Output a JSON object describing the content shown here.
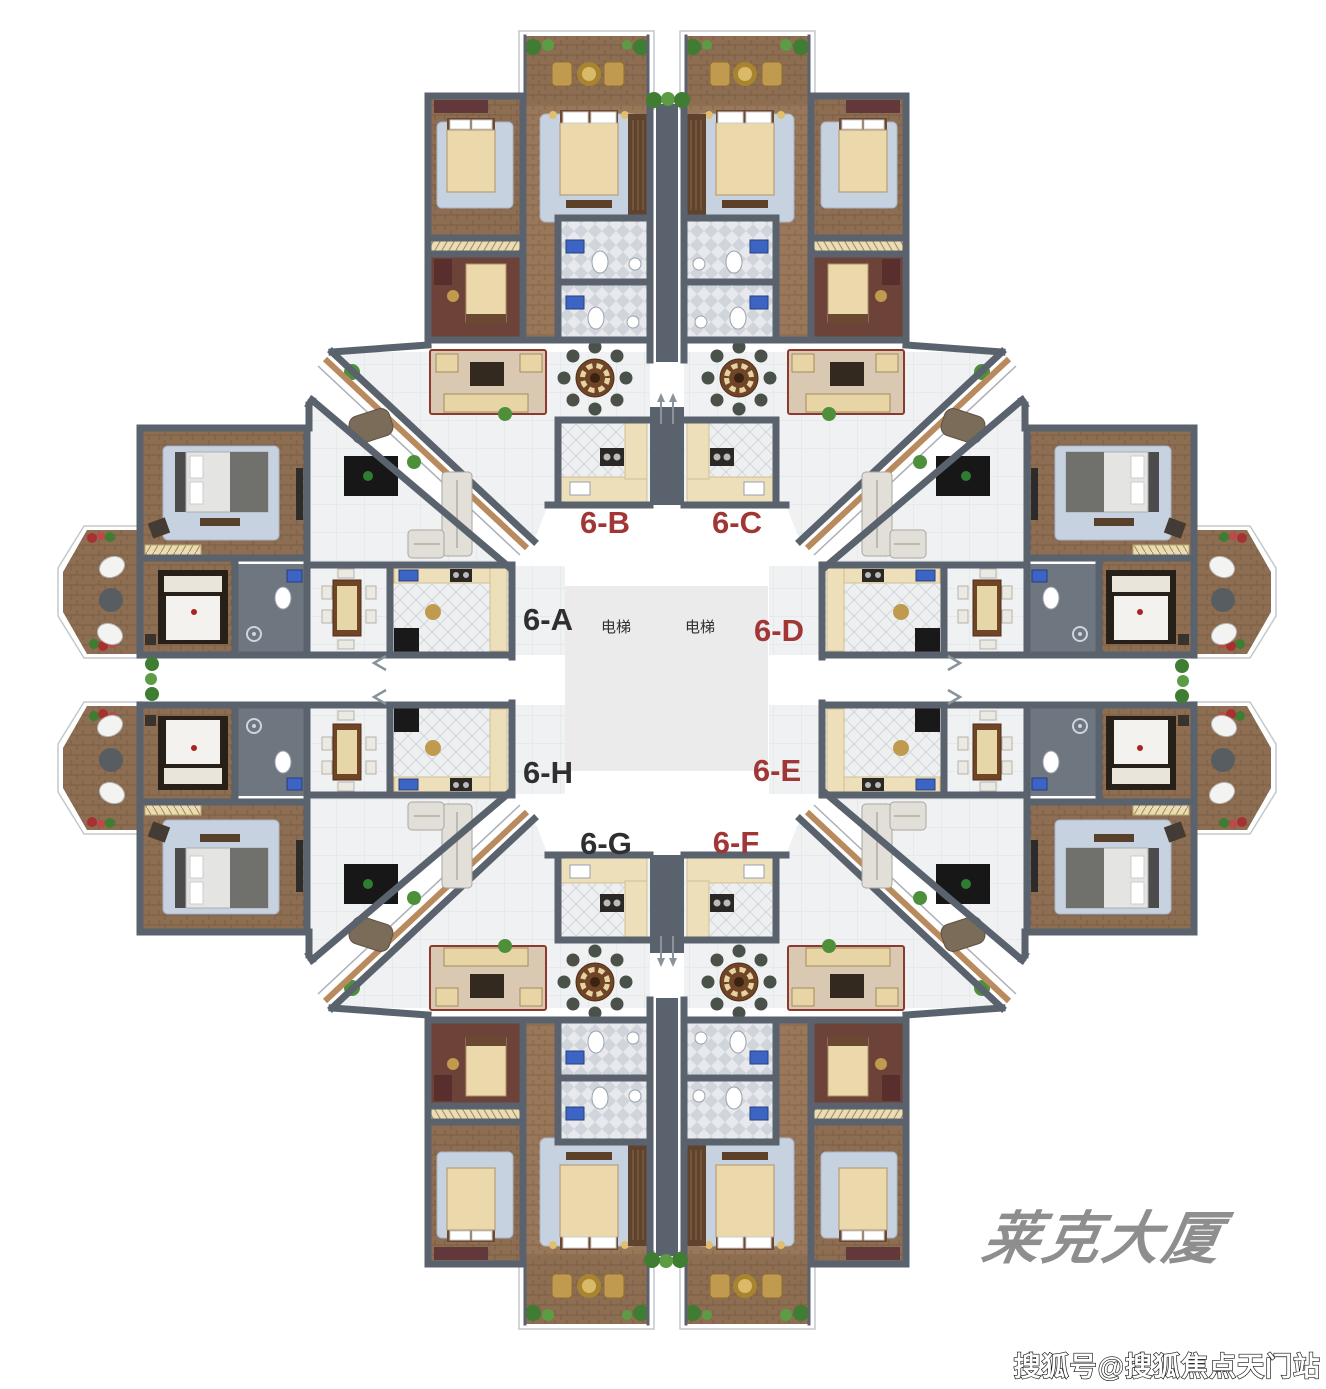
{
  "plan": {
    "core": {
      "fill": "#ebebeb",
      "elevator_labels": [
        "电梯",
        "电梯"
      ],
      "elevator_text_color": "#2f2f2f"
    },
    "unit_labels": [
      {
        "id": "6-A",
        "label": "6-A",
        "color": "#2f2f2f"
      },
      {
        "id": "6-B",
        "label": "6-B",
        "color": "#a13636"
      },
      {
        "id": "6-C",
        "label": "6-C",
        "color": "#a13636"
      },
      {
        "id": "6-D",
        "label": "6-D",
        "color": "#a13636"
      },
      {
        "id": "6-E",
        "label": "6-E",
        "color": "#a13636"
      },
      {
        "id": "6-F",
        "label": "6-F",
        "color": "#a13636"
      },
      {
        "id": "6-G",
        "label": "6-G",
        "color": "#2f2f2f"
      },
      {
        "id": "6-H",
        "label": "6-H",
        "color": "#2f2f2f"
      }
    ],
    "palette": {
      "wall": "#59626d",
      "wood": "#8d6e52",
      "wood_light": "#99775a",
      "maroon": "#6d4238",
      "rug_blue": "#c7d2e0",
      "bed_cream": "#ecd9ab",
      "counter_cream": "#ecdfba",
      "plant_green": "#3f7d33",
      "fixture_blue": "#3b64c4",
      "marble": "#eff1f3"
    }
  },
  "branding": {
    "building_name": "莱克大厦",
    "color": "#8e8e8e"
  },
  "watermark": {
    "text": "搜狐号@搜狐焦点天门站"
  }
}
